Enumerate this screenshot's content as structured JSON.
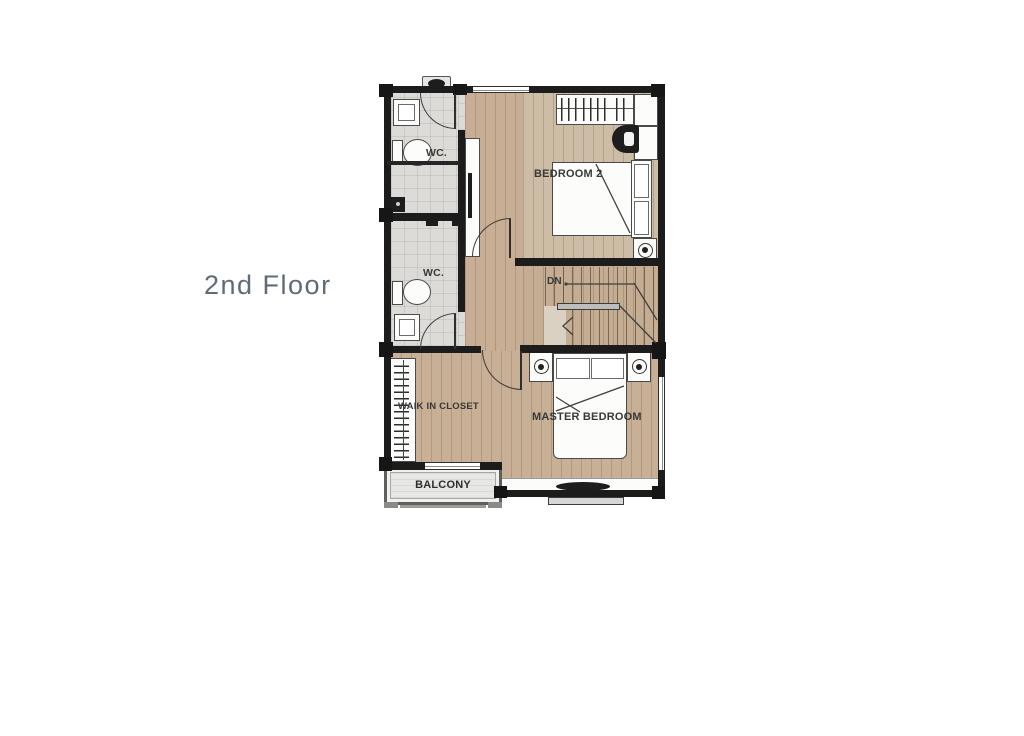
{
  "title": "2nd Floor",
  "labels": {
    "floor": "2nd Floor",
    "wc_top": "WC.",
    "wc_bottom": "WC.",
    "bedroom2": "BEDROOM 2",
    "master_bedroom": "MASTER BEDROOM",
    "walk_in_closet": "WAIK IN CLOSET",
    "balcony": "BALCONY",
    "stairs_down": "DN"
  },
  "rooms": [
    {
      "name": "WC (top)",
      "features": [
        "sink",
        "toilet",
        "shower",
        "swing door"
      ]
    },
    {
      "name": "WC (bottom)",
      "features": [
        "shower",
        "toilet",
        "sink",
        "swing door"
      ]
    },
    {
      "name": "Bedroom 2",
      "features": [
        "wardrobe with hangers",
        "basin counter",
        "double bed",
        "nightstand with lamp"
      ]
    },
    {
      "name": "Stair hall",
      "features": [
        "stairs down",
        "handrail",
        "direction arrow"
      ]
    },
    {
      "name": "Walk-in closet",
      "features": [
        "hanging rail"
      ]
    },
    {
      "name": "Master bedroom",
      "features": [
        "double bed",
        "two nightstands with lamps",
        "window wall"
      ]
    },
    {
      "name": "Balcony",
      "features": [
        "railing",
        "sliding door"
      ]
    }
  ],
  "colors": {
    "wall": "#1c1c1c",
    "wood_floor": "#c7ae94",
    "wood_floor_light": "#cdbca6",
    "tile_floor": "#dcdbd7",
    "floor_title_text": "#5e6c7a",
    "room_label_text": "#383838",
    "paper": "#ffffff"
  }
}
